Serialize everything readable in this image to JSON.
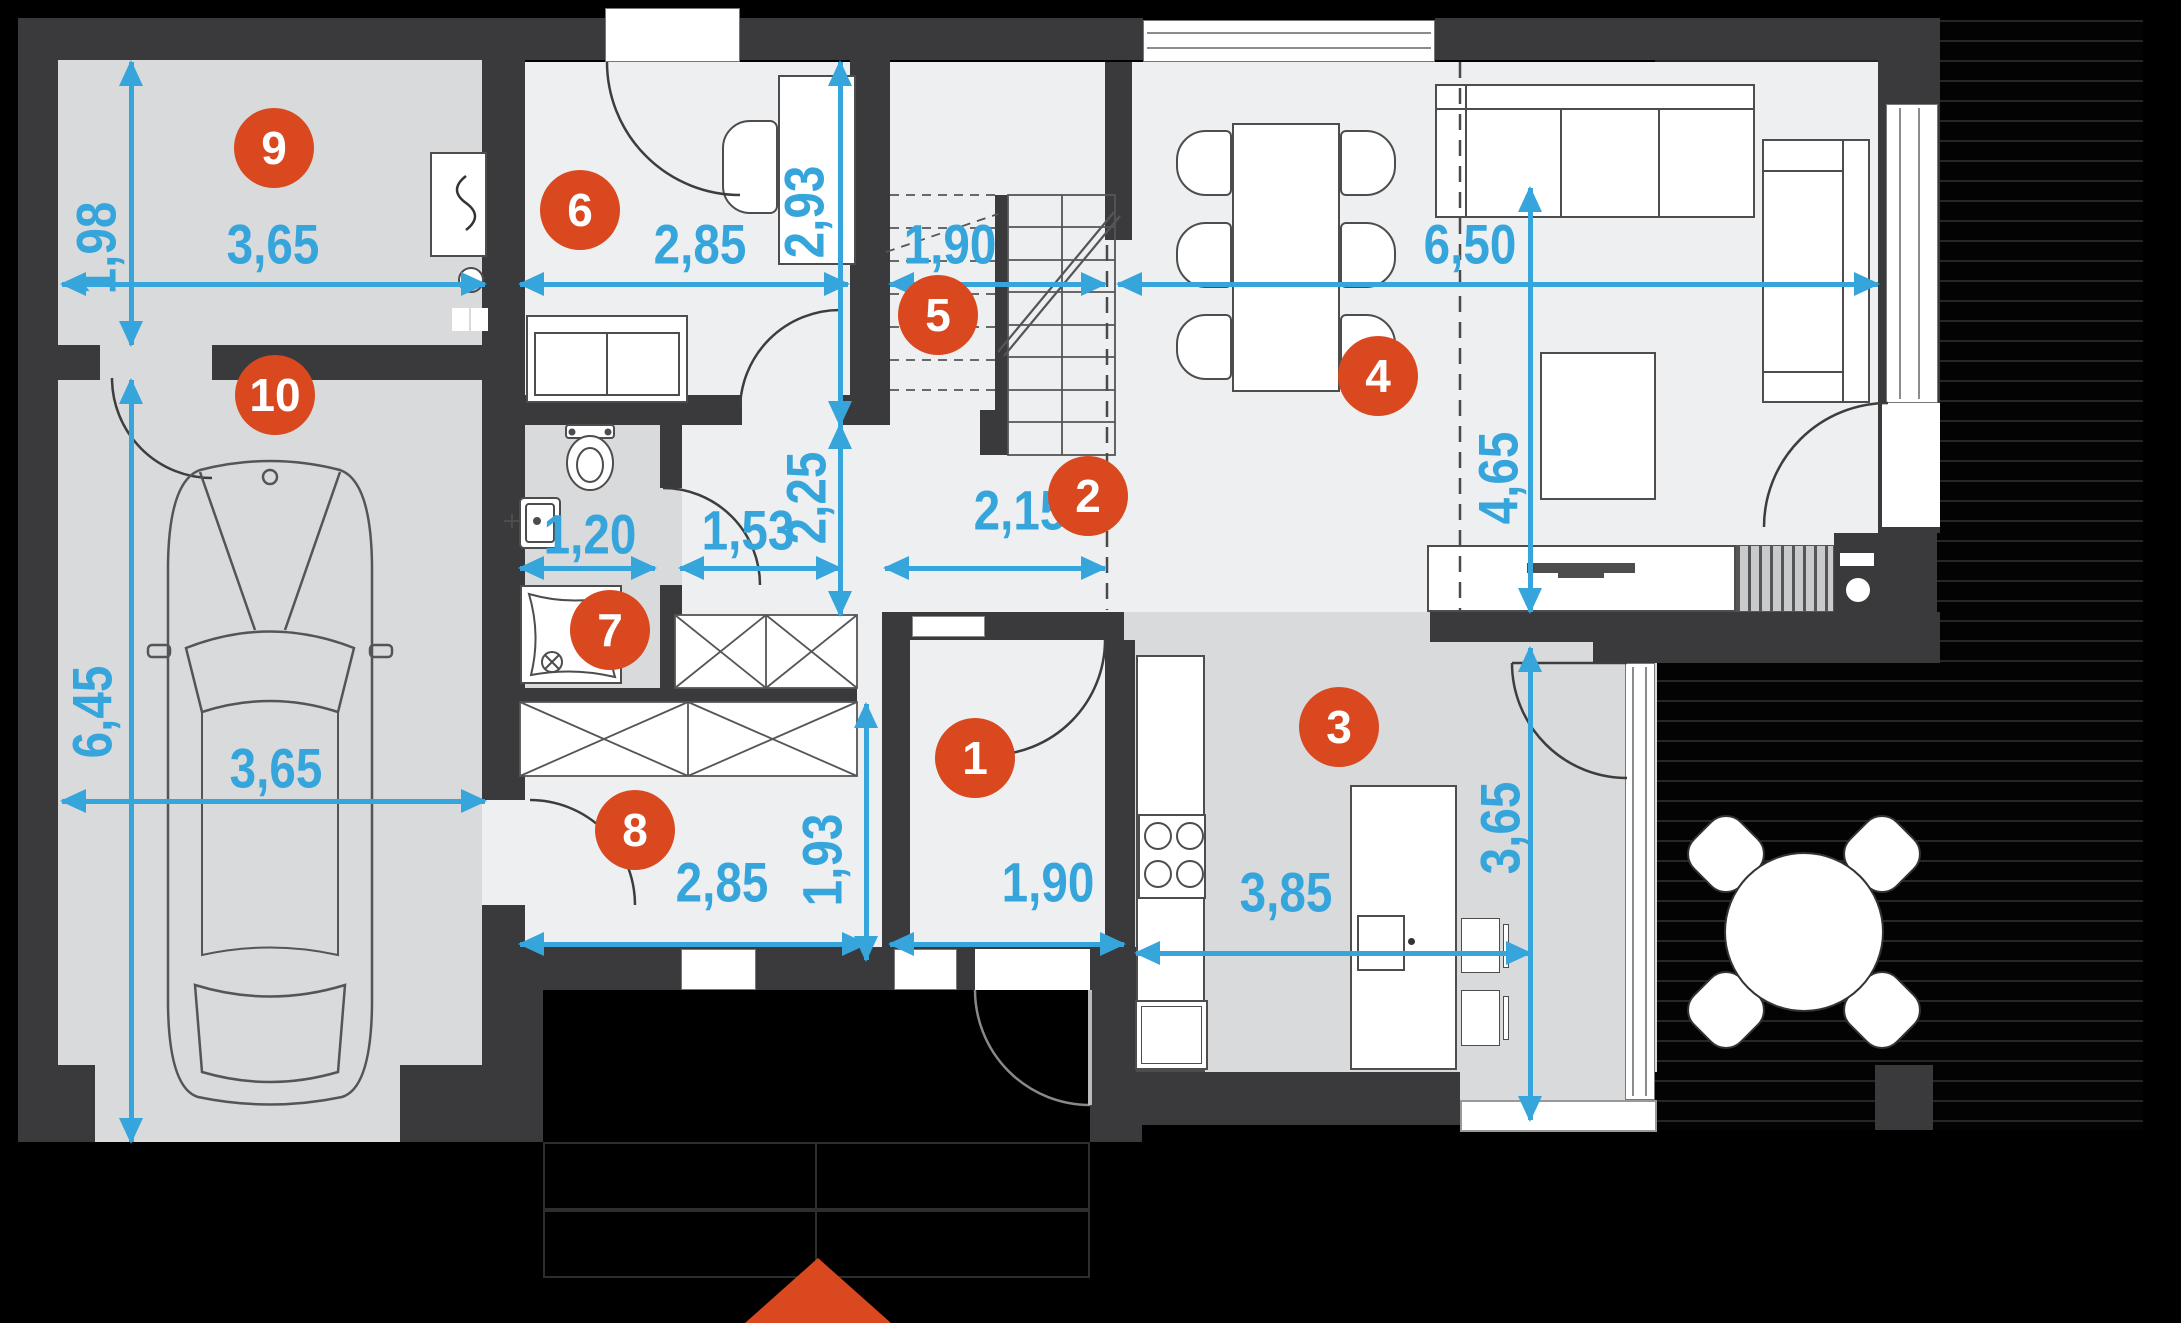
{
  "plan": {
    "type": "floor-plan",
    "units": "meters-with-comma-decimal"
  },
  "colors": {
    "accent_orange": "#D9481E",
    "dimension_blue": "#36A5DC",
    "wall_dark": "#3A3A3C",
    "floor_light": "#EDEFF0",
    "floor_dark": "#D8DADB",
    "outside_black": "#000000"
  },
  "rooms": {
    "r1": {
      "number": "1"
    },
    "r2": {
      "number": "2"
    },
    "r3": {
      "number": "3"
    },
    "r4": {
      "number": "4"
    },
    "r5": {
      "number": "5"
    },
    "r6": {
      "number": "6"
    },
    "r7": {
      "number": "7"
    },
    "r8": {
      "number": "8"
    },
    "r9": {
      "number": "9"
    },
    "r10": {
      "number": "10"
    }
  },
  "dims": {
    "room9_w": {
      "label": "3,65",
      "orientation": "horizontal"
    },
    "room9_h": {
      "label": "1,98",
      "orientation": "vertical"
    },
    "garage_w": {
      "label": "3,65",
      "orientation": "horizontal"
    },
    "garage_h": {
      "label": "6,45",
      "orientation": "vertical"
    },
    "room6_w": {
      "label": "2,85",
      "orientation": "horizontal"
    },
    "room6_h": {
      "label": "2,93",
      "orientation": "vertical"
    },
    "stairs_w": {
      "label": "1,90",
      "orientation": "horizontal"
    },
    "living_w": {
      "label": "6,50",
      "orientation": "horizontal"
    },
    "living_h": {
      "label": "4,65",
      "orientation": "vertical"
    },
    "wc_w": {
      "label": "1,20",
      "orientation": "horizontal"
    },
    "hall_w": {
      "label": "1,53",
      "orientation": "horizontal"
    },
    "hall_h": {
      "label": "2,25",
      "orientation": "vertical"
    },
    "hall2_w": {
      "label": "2,15",
      "orientation": "horizontal"
    },
    "room8_w": {
      "label": "2,85",
      "orientation": "horizontal"
    },
    "room8_h": {
      "label": "1,93",
      "orientation": "vertical"
    },
    "room1_w": {
      "label": "1,90",
      "orientation": "horizontal"
    },
    "kitchen_w": {
      "label": "3,85",
      "orientation": "horizontal"
    },
    "kitchen_h": {
      "label": "3,65",
      "orientation": "vertical"
    }
  },
  "markers": {
    "entrance_arrow": {
      "icon": "up-triangle",
      "color": "#D9481E"
    }
  }
}
